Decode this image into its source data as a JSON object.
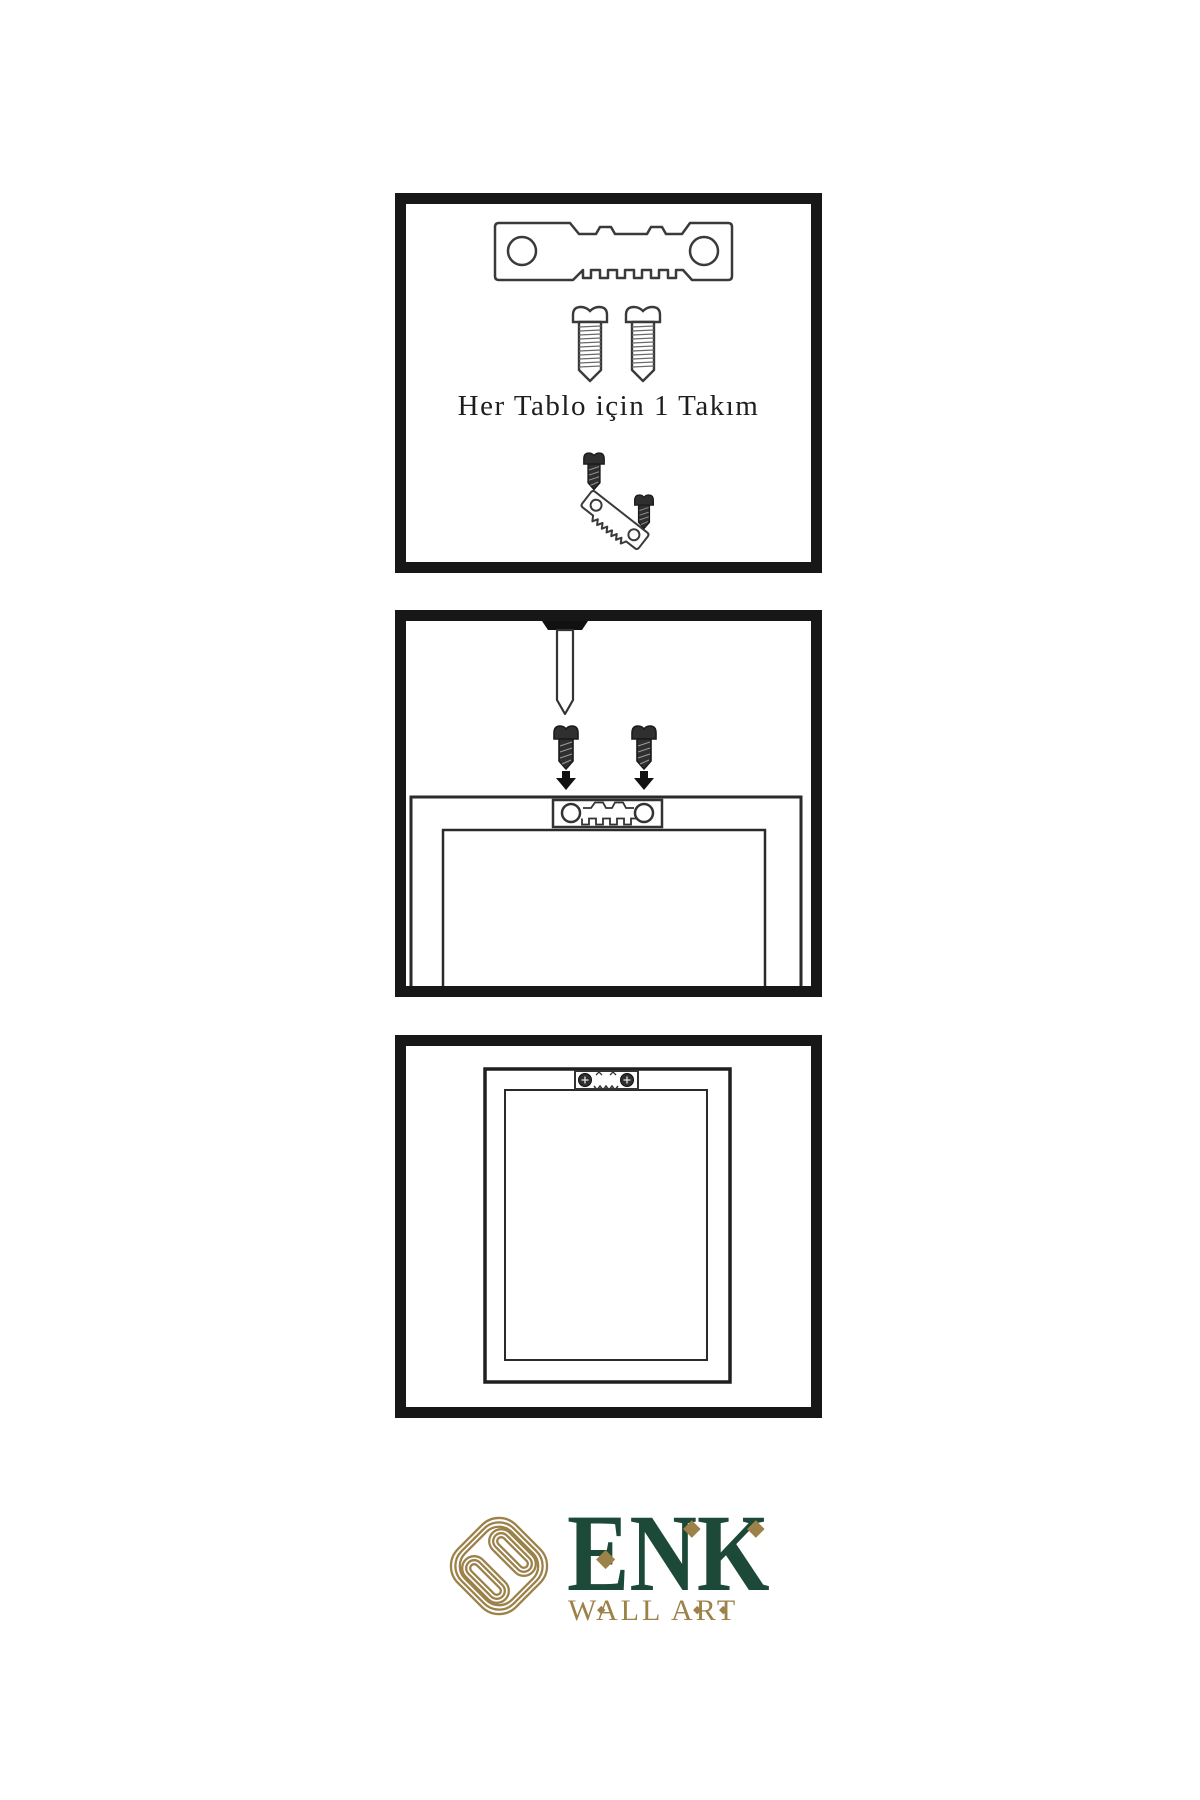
{
  "page": {
    "background": "#ffffff"
  },
  "caption": {
    "text": "Her Tablo için 1 Takım"
  },
  "brand": {
    "name": "ENK",
    "tagline": "WALL ART",
    "green": "#1d4939",
    "gold": "#9c8148"
  },
  "colors": {
    "panel_border": "#171717",
    "illustration_line": "#3a3a3a",
    "screw_dark_fill": "#2f2f2f",
    "nail_head_fill": "#111111",
    "background": "#ffffff"
  },
  "icons": {
    "panel_hardware_kit": [
      "sawtooth-hanger-icon",
      "screw-icon",
      "screw-icon",
      "screw-into-hanger-icon"
    ],
    "panel_attach_hanger": [
      "nail-icon",
      "screw-icon",
      "screw-icon",
      "arrow-down-icon",
      "arrow-down-icon",
      "frame-back-icon",
      "sawtooth-hanger-icon"
    ],
    "panel_hang_frame": [
      "frame-back-icon",
      "mounted-sawtooth-hanger-icon"
    ],
    "brand": [
      "knot-logo-icon",
      "diamond-accent-icon",
      "diamond-accent-icon",
      "diamond-accent-icon"
    ]
  }
}
